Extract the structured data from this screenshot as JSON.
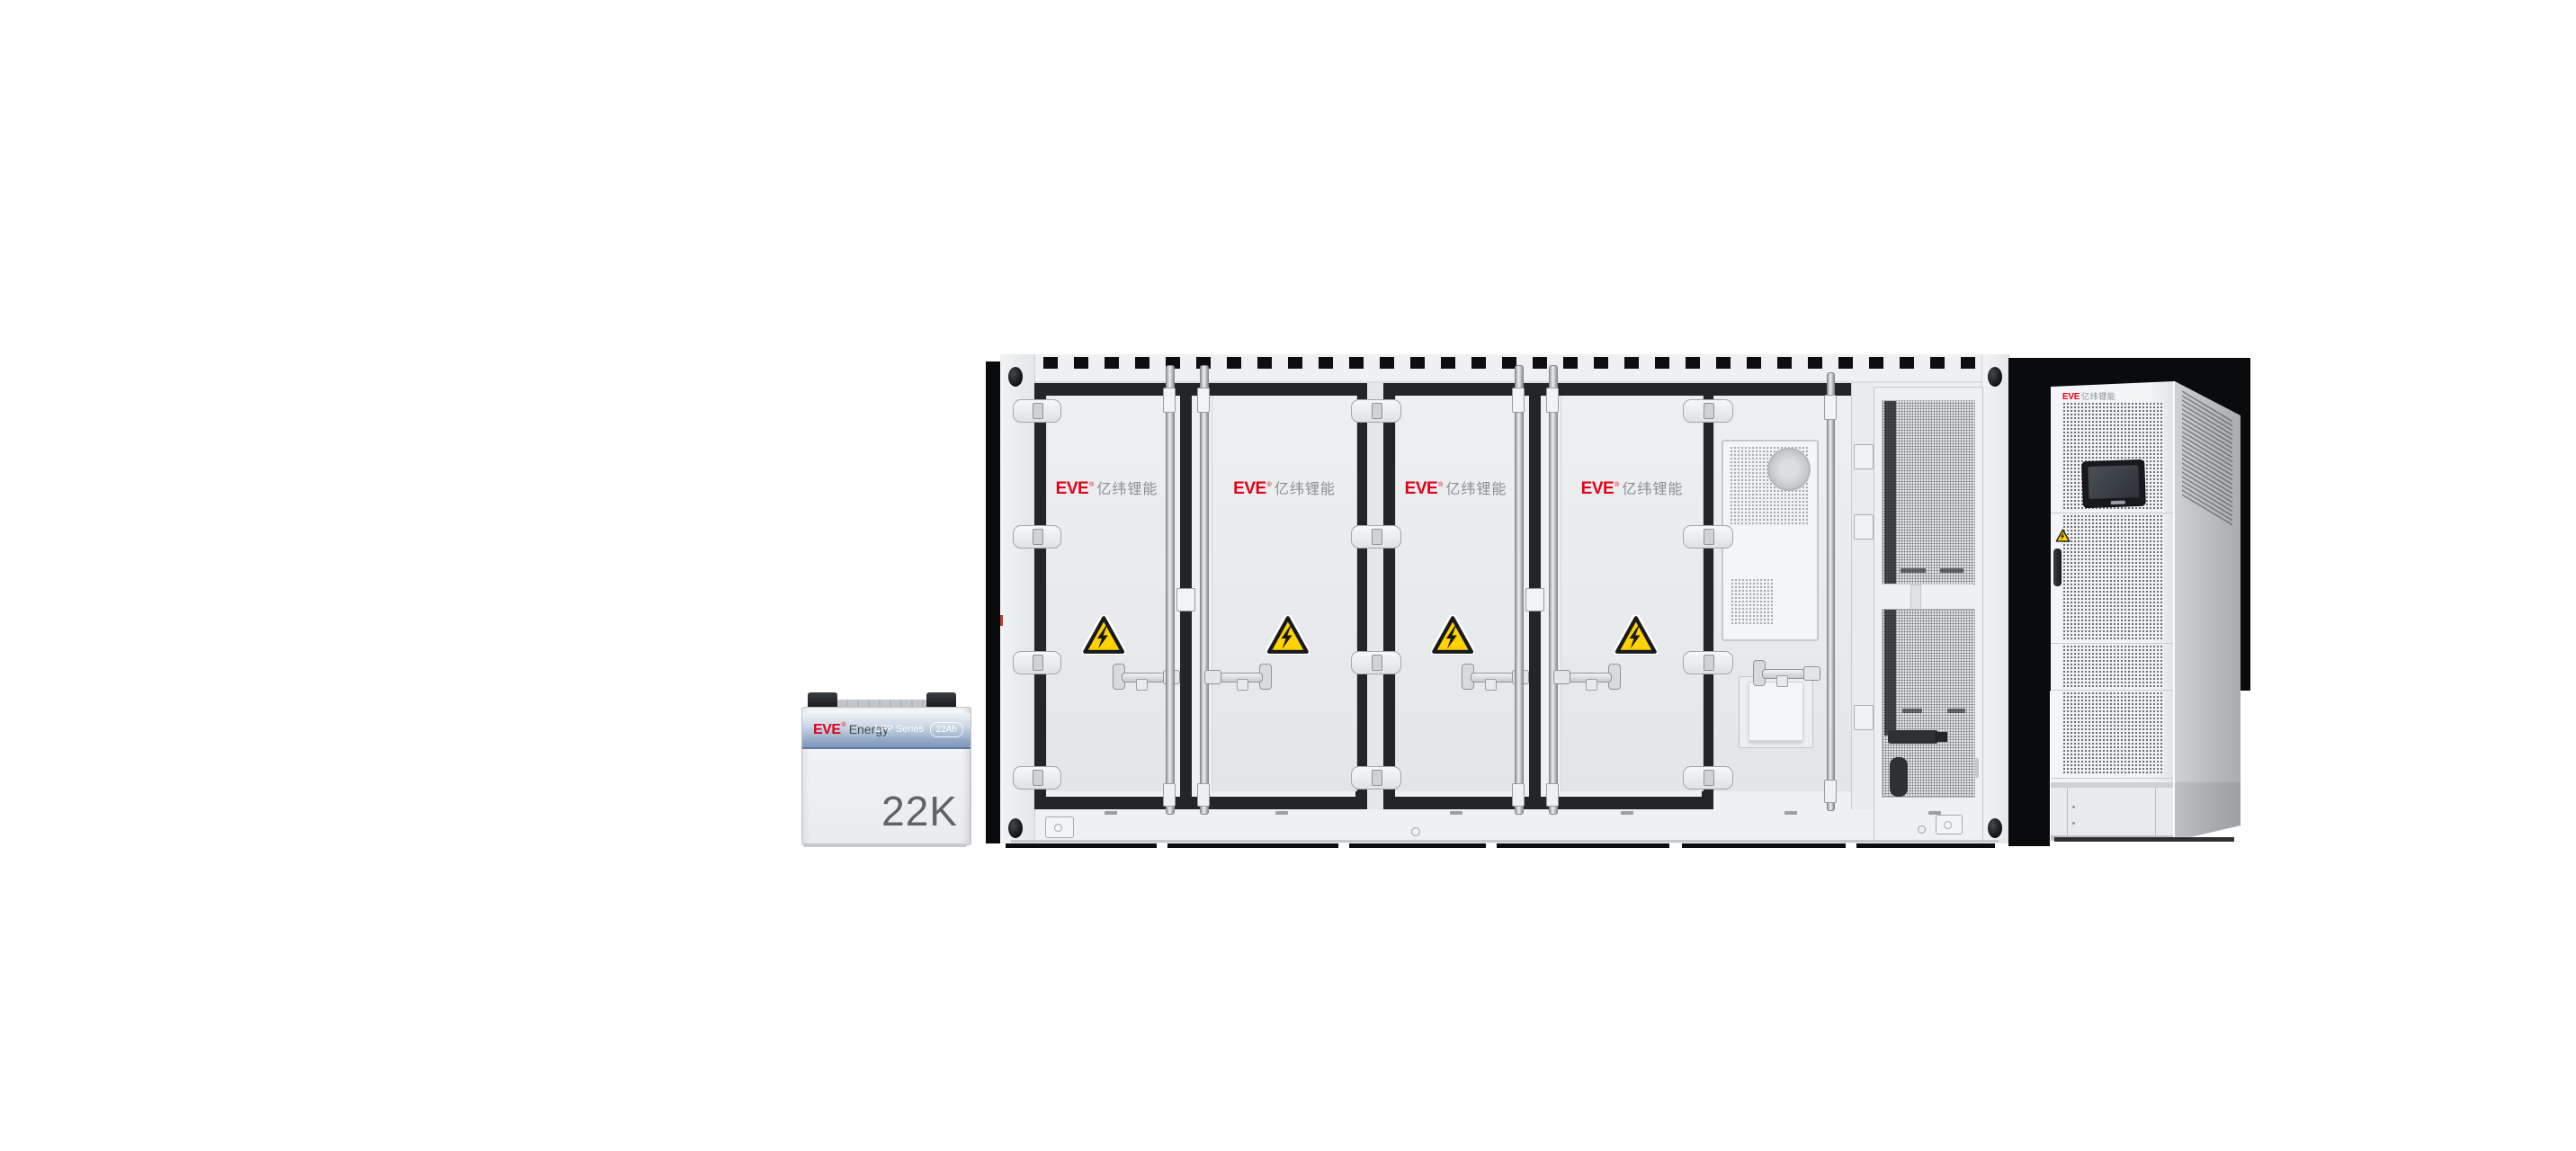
{
  "battery_cell": {
    "brand": "EVE",
    "brand_reg": "®",
    "brand_suffix": "Energy",
    "series_label": "LFP Series",
    "capacity_badge": "22Ah",
    "model": "22K",
    "colors": {
      "brand_red": "#df0019",
      "band_blue": "#7e97b9",
      "model_text": "#5f6468"
    }
  },
  "container": {
    "brand": "EVE",
    "brand_reg": "®",
    "brand_cn": "亿纬锂能",
    "door_leaves": 4,
    "icons": {
      "door_hazard": "high-voltage-warning-triangle"
    },
    "colors": {
      "body": "#eef0f2",
      "gasket": "#232629",
      "hazard_yellow": "#ffd200",
      "brand_red": "#e2001a"
    }
  },
  "pcs_cabinet": {
    "brand": "EVE",
    "brand_cn": "亿纬锂能",
    "icons": {
      "door_hazard": "warning-triangle",
      "display": "hmi-touchscreen"
    },
    "colors": {
      "front": "#f2f3f5",
      "side": "#c2c6c9",
      "screen_bezel": "#17191c"
    }
  }
}
